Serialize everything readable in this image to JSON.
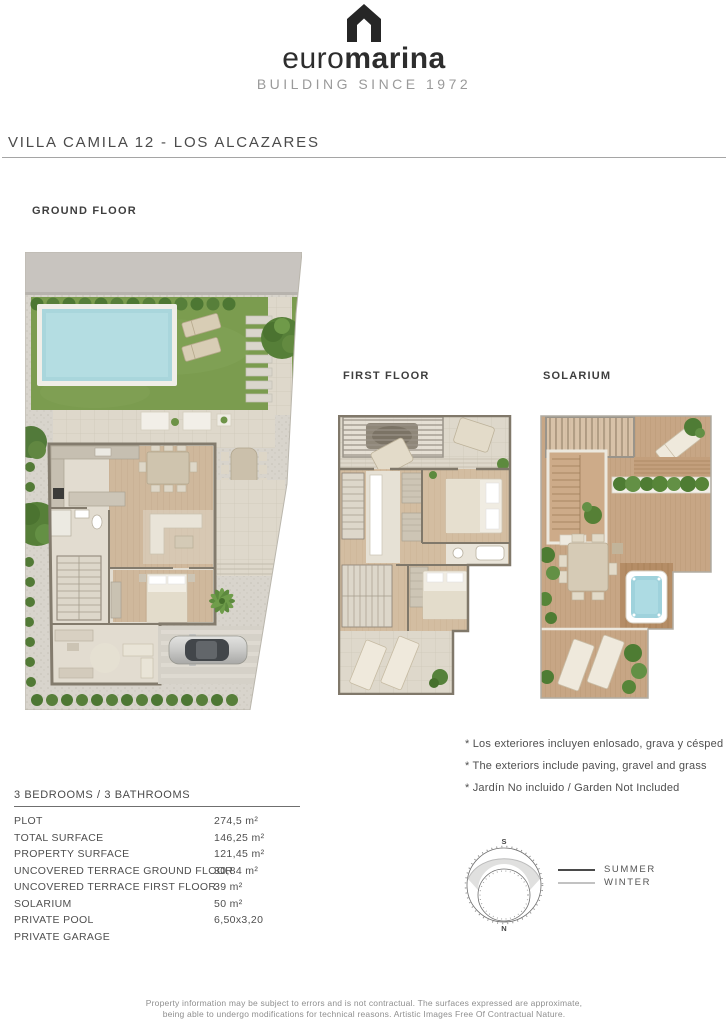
{
  "logo": {
    "word_light": "euro",
    "word_bold": "marina",
    "tagline": "BUILDING SINCE 1972"
  },
  "title": "VILLA CAMILA 12 - LOS ALCAZARES",
  "plans": {
    "ground": {
      "label": "GROUND FLOOR"
    },
    "first": {
      "label": "FIRST FLOOR"
    },
    "solarium": {
      "label": "SOLARIUM"
    }
  },
  "notes": [
    "* Los exteriores incluyen enlosado, grava y césped",
    "* The exteriors include paving, gravel and grass",
    "* Jardín No incluido / Garden Not Included"
  ],
  "specs": {
    "header": "3 BEDROOMS / 3 BATHROOMS",
    "rows": [
      {
        "label": "PLOT",
        "value": "274,5 m²"
      },
      {
        "label": "TOTAL SURFACE",
        "value": "146,25 m²"
      },
      {
        "label": "PROPERTY SURFACE",
        "value": "121,45 m²"
      },
      {
        "label": "UNCOVERED TERRACE GROUND FLOOR",
        "value": "30,84 m²"
      },
      {
        "label": "UNCOVERED TERRACE FIRST FLOOR",
        "value": "39 m²"
      },
      {
        "label": "SOLARIUM",
        "value": "50 m²"
      },
      {
        "label": "PRIVATE POOL",
        "value": "6,50x3,20"
      },
      {
        "label": "PRIVATE GARAGE",
        "value": ""
      }
    ]
  },
  "sun_diagram": {
    "south": "S",
    "north": "N",
    "legend": [
      {
        "label": "SUMMER"
      },
      {
        "label": "WINTER"
      }
    ]
  },
  "footer": {
    "line1": "Property information may be subject to errors and is not contractual. The surfaces expressed are approximate,",
    "line2": "being able to undergo modifications for technical reasons. Artistic Images Free Of Contractual Nature."
  },
  "palette": {
    "brand_dark": "#2d2d2d",
    "grass": "#7b9c4f",
    "pool_water": "#a9d6dc",
    "deck_wood": "#c7a685",
    "interior_wood": "#cfb89c",
    "tile": "#ded8cb",
    "road": "#c8c4bf",
    "gravel": "#d8d4cc",
    "hedge": "#4d7733",
    "wall": "#837b6d"
  }
}
